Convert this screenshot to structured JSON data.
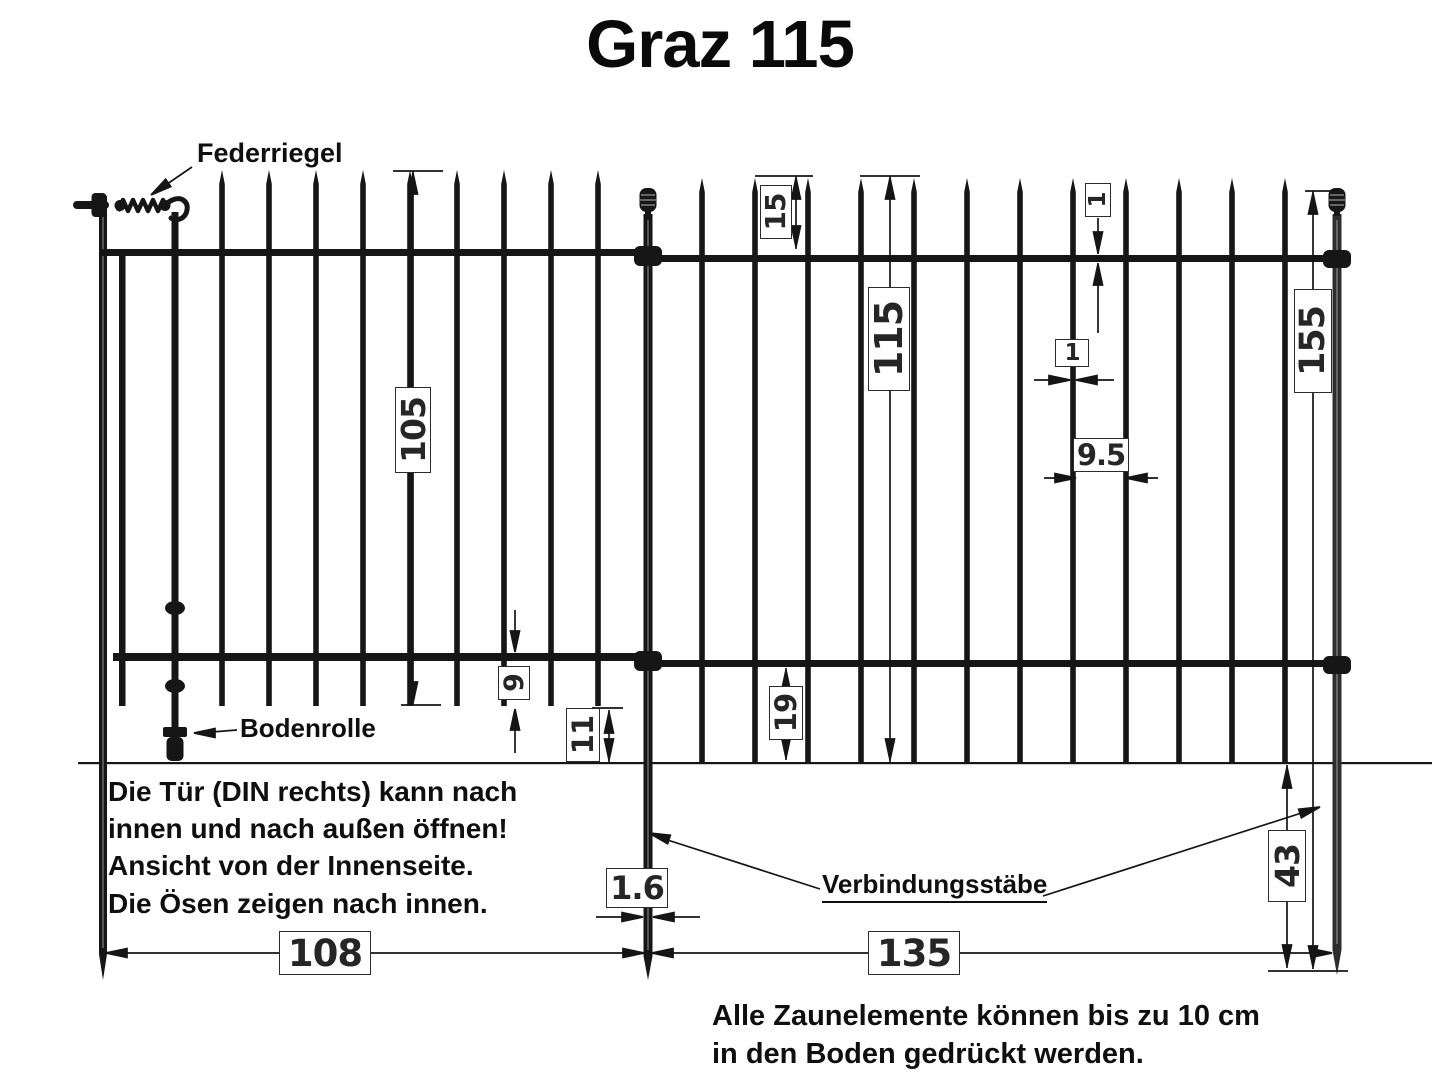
{
  "title": "Graz 115",
  "callouts": {
    "federriegel": "Federriegel",
    "bodenrolle": "Bodenrolle",
    "verbindungsstaebe": "Verbindungsstäbe"
  },
  "dimensions": {
    "gate_height": "105",
    "spike_above_top_rail": "15",
    "element_height": "115",
    "rail_thickness": "1",
    "bar_thickness": "1",
    "bar_spacing": "9.5",
    "connecting_rod_length": "155",
    "gate_bar_overhang": "9",
    "gate_ground_clearance": "11",
    "panel_bar_overhang": "19",
    "rod_diameter": "1.6",
    "gate_width": "108",
    "panel_width": "135",
    "rod_depth_underground": "43"
  },
  "notes": {
    "gate_note": [
      "Die Tür (DIN rechts) kann nach",
      "innen und nach außen öffnen!",
      "Ansicht von der Innenseite.",
      "Die Ösen zeigen nach innen."
    ],
    "ground_note": [
      "Alle Zaunelemente können bis zu 10 cm",
      "in den Boden gedrückt werden."
    ]
  },
  "colors": {
    "ink": "#111111",
    "background": "#ffffff"
  }
}
